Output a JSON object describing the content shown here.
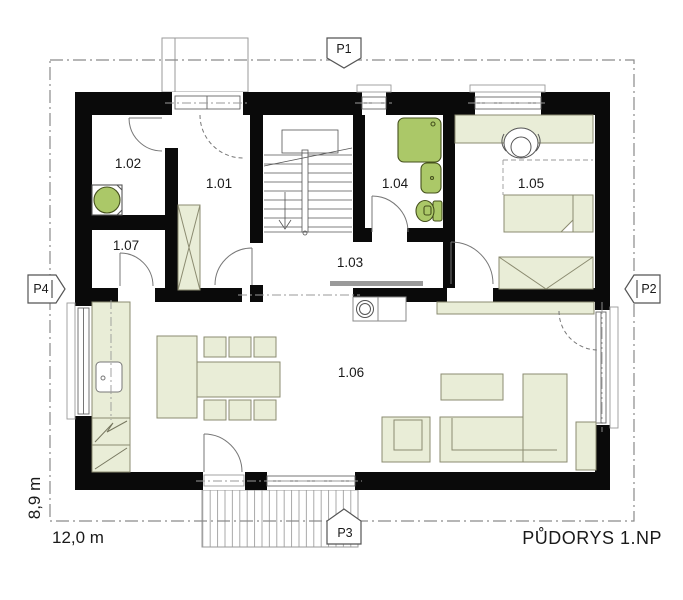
{
  "title": {
    "label": "PŮDORYS 1.NP"
  },
  "dimensions": {
    "width": "12,0 m",
    "height": "8,9 m"
  },
  "markers": {
    "p1": {
      "label": "P1"
    },
    "p2": {
      "label": "P2"
    },
    "p3": {
      "label": "P3"
    },
    "p4": {
      "label": "P4"
    }
  },
  "rooms": [
    {
      "id": "1.01",
      "label": "1.01"
    },
    {
      "id": "1.02",
      "label": "1.02"
    },
    {
      "id": "1.03",
      "label": "1.03"
    },
    {
      "id": "1.04",
      "label": "1.04"
    },
    {
      "id": "1.05",
      "label": "1.05"
    },
    {
      "id": "1.06",
      "label": "1.06"
    },
    {
      "id": "1.07",
      "label": "1.07"
    }
  ],
  "colors": {
    "wall": "#0a0a0a",
    "furniture_fill": "#e9edd7",
    "furniture_stroke": "#8b8b70",
    "fixture_fill": "#abc868",
    "fixture_stroke": "#45501d",
    "deck_line": "#a0a0a0",
    "boundary_line": "#8a8a8a",
    "axis_line": "#999999",
    "door_line": "#777777"
  }
}
